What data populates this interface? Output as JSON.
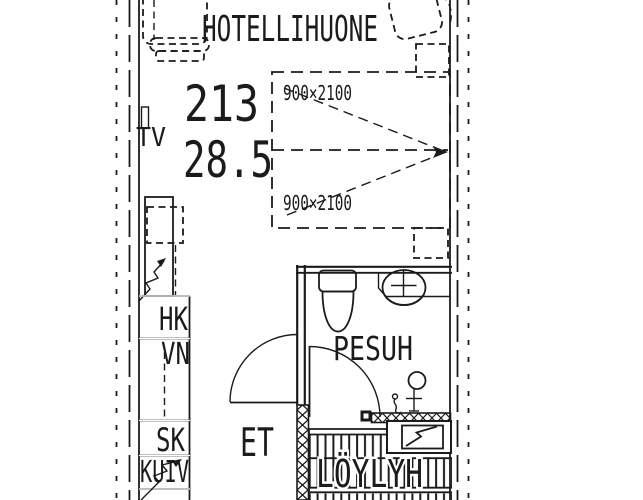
{
  "plan": {
    "title": "HOTELLIHUONE",
    "room_number": "213",
    "area": "28.5",
    "bed_size_top": "900×2100",
    "bed_size_bottom": "900×2100",
    "tv_label": "TV",
    "bathroom_label": "PESUH",
    "entry_label": "ET",
    "sauna_label": "LÖYLYH",
    "closets": {
      "hk": "HK",
      "vn": "VN",
      "sk": "SK",
      "kuiv": "KUIV"
    }
  },
  "colors": {
    "background": "#ffffff",
    "line": "#1b1b1b"
  }
}
